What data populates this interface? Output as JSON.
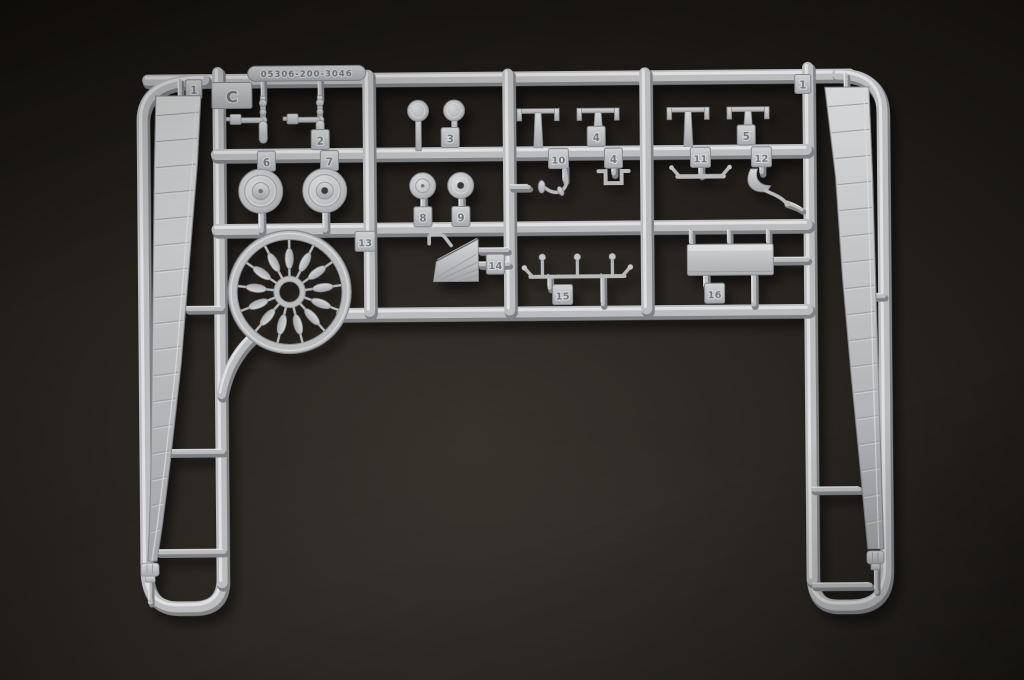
{
  "photo": {
    "background_color": "#26231f",
    "plastic_color": "#bcbec0",
    "subject": "model kit sprue"
  },
  "sprue": {
    "gate_letter": "C",
    "mold_code": "05306-200-3046",
    "tabs": {
      "c": "C",
      "blade_left": "1",
      "blade_right": "1",
      "p2": "2",
      "p3": "3",
      "p4": "4",
      "p4b": "4",
      "p5": "5",
      "p6": "6",
      "p7": "7",
      "p8": "8",
      "p9": "9",
      "p10": "10",
      "p11": "11",
      "p12": "12",
      "p13": "13",
      "p14": "14",
      "p15": "15",
      "p16": "16"
    }
  }
}
